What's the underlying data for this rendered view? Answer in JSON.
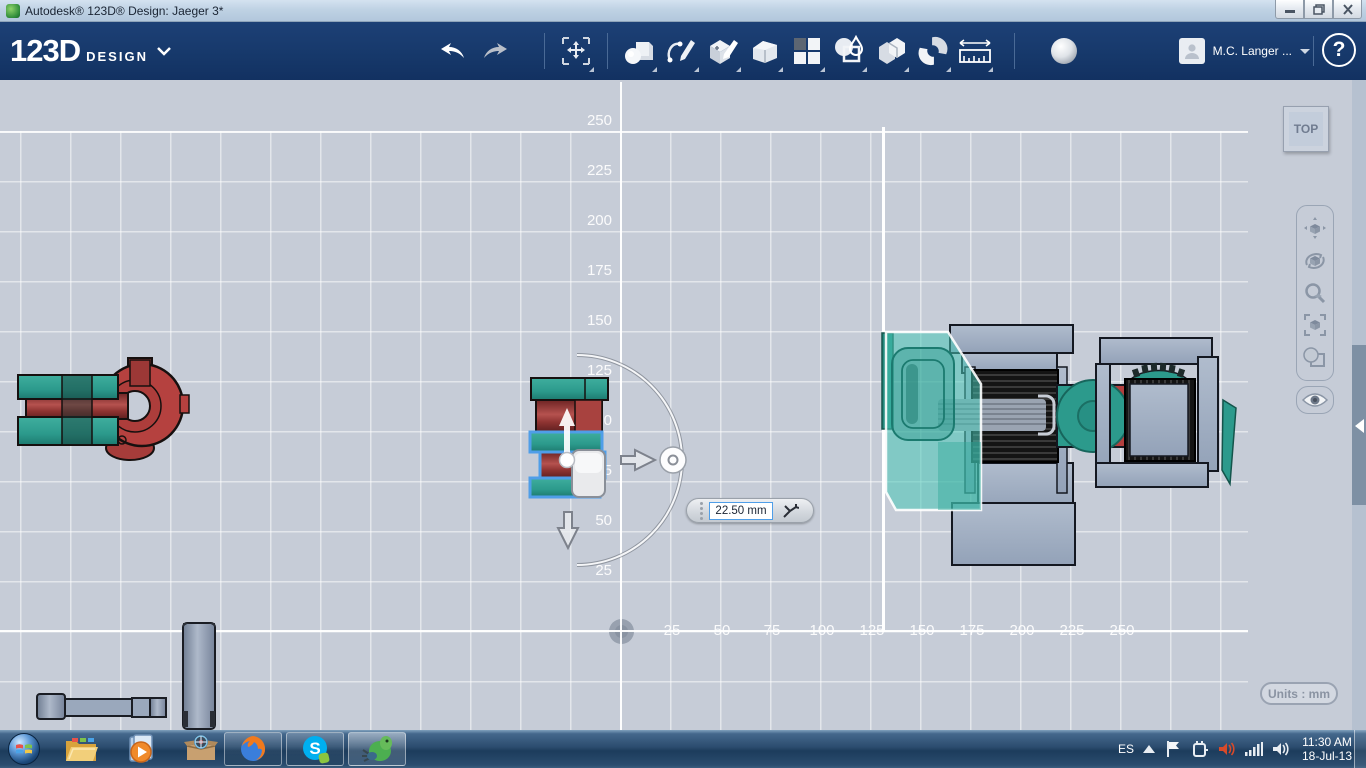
{
  "window": {
    "title": "Autodesk® 123D® Design: Jaeger 3*"
  },
  "toolbar": {
    "logo": "123D",
    "logo_sub": "DESIGN",
    "user_name": "M.C. Langer ...",
    "help_label": "?",
    "tools": [
      "transform",
      "primitives",
      "sketch",
      "construct",
      "modify",
      "pattern",
      "combine",
      "split",
      "snap",
      "measure",
      "material"
    ]
  },
  "canvas": {
    "viewcube_label": "TOP",
    "units_label": "Units : mm",
    "dimension_value": "22.50 mm",
    "x_axis_labels": [
      "25",
      "50",
      "75",
      "100",
      "125",
      "150",
      "175",
      "200",
      "225",
      "250"
    ],
    "y_axis_labels": [
      "250",
      "225",
      "200",
      "175",
      "150",
      "125",
      "100",
      "75",
      "50",
      "25"
    ]
  },
  "taskbar": {
    "tray": {
      "language": "ES",
      "time": "11:30 AM",
      "date": "18-Jul-13"
    }
  },
  "icons": {
    "titlebar": [
      "app-icon",
      "minimize-icon",
      "restore-icon",
      "close-icon"
    ],
    "toolbar": [
      "undo-icon",
      "redo-icon",
      "transform-icon",
      "primitives-icon",
      "sketch-icon",
      "construct-icon",
      "modify-icon",
      "pattern-icon",
      "combine-icon",
      "split-icon",
      "snap-icon",
      "measure-icon",
      "material-sphere-icon",
      "avatar-icon",
      "dropdown-caret-icon",
      "help-icon"
    ],
    "nav": [
      "pan-icon",
      "orbit-icon",
      "zoom-icon",
      "fit-icon",
      "shade-icon",
      "visibility-eye-icon"
    ],
    "taskbar": [
      "start-orb-icon",
      "explorer-icon",
      "media-player-icon",
      "box-app-icon",
      "firefox-icon",
      "skype-icon",
      "123d-app-icon",
      "tray-expand-icon",
      "flag-icon",
      "power-plug-icon",
      "audio-app-icon",
      "network-signal-icon",
      "volume-icon"
    ]
  },
  "colors": {
    "toolbar_navy": "#16386a",
    "canvas_bg": "#c6ccd7",
    "selection_blue": "#4f9ee8",
    "teal": "#2c9a8c",
    "red": "#b23f3e",
    "steel": "#a2b0c4"
  }
}
